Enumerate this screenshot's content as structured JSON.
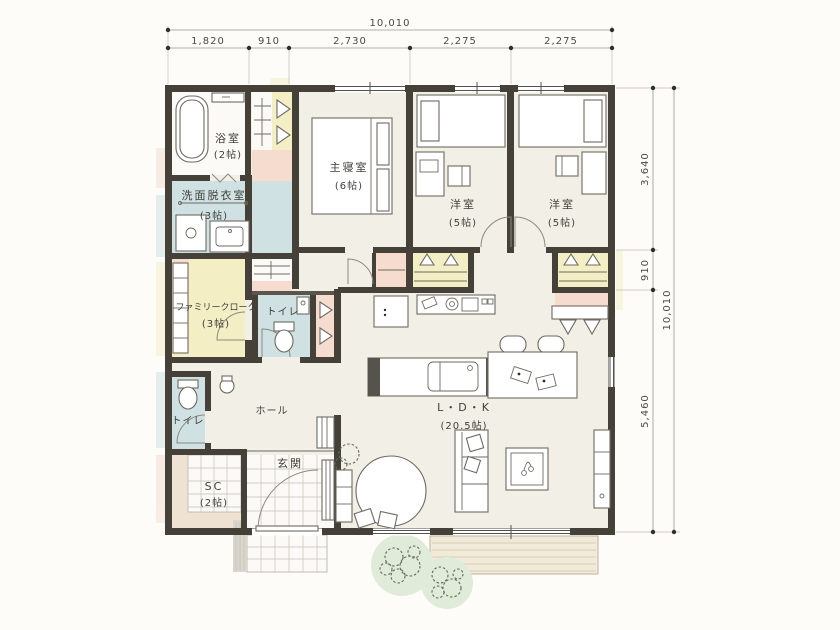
{
  "plan_title": "single-story house floor plan",
  "dimensions": {
    "top": {
      "total": "10,010",
      "segments": [
        "1,820",
        "910",
        "2,730",
        "2,275",
        "2,275"
      ]
    },
    "right": {
      "total": "10,010",
      "segments": [
        "3,640",
        "910",
        "5,460"
      ]
    }
  },
  "rooms": {
    "bath": {
      "label": "浴室",
      "size": "(2帖)"
    },
    "washroom": {
      "label": "洗面脱衣室",
      "size": "(3帖)"
    },
    "family_closet": {
      "label": "ファミリークローク",
      "size": "(3帖)"
    },
    "toilet_center": {
      "label": "トイレ"
    },
    "toilet_west": {
      "label": "トイレ"
    },
    "hall": {
      "label": "ホール"
    },
    "entrance": {
      "label": "玄関"
    },
    "shoe_closet": {
      "label": "SC",
      "size": "(2帖)"
    },
    "master_bedroom": {
      "label": "主寝室",
      "size": "(6帖)"
    },
    "bedroom_center": {
      "label": "洋室",
      "size": "(5帖)"
    },
    "bedroom_east": {
      "label": "洋室",
      "size": "(5帖)"
    },
    "ldk": {
      "label": "L・D・K",
      "size": "(20.5帖)"
    }
  },
  "colors": {
    "wall": "#454139",
    "floor": "#f2efe7",
    "wet_area_blue": "#cfe1e3",
    "closet_yellow": "#f4eec5",
    "closet_pink": "#f5dcce",
    "entrance_beige": "#f0e2d3",
    "deck": "#f1ead9",
    "greenery": "#5c6e55"
  }
}
